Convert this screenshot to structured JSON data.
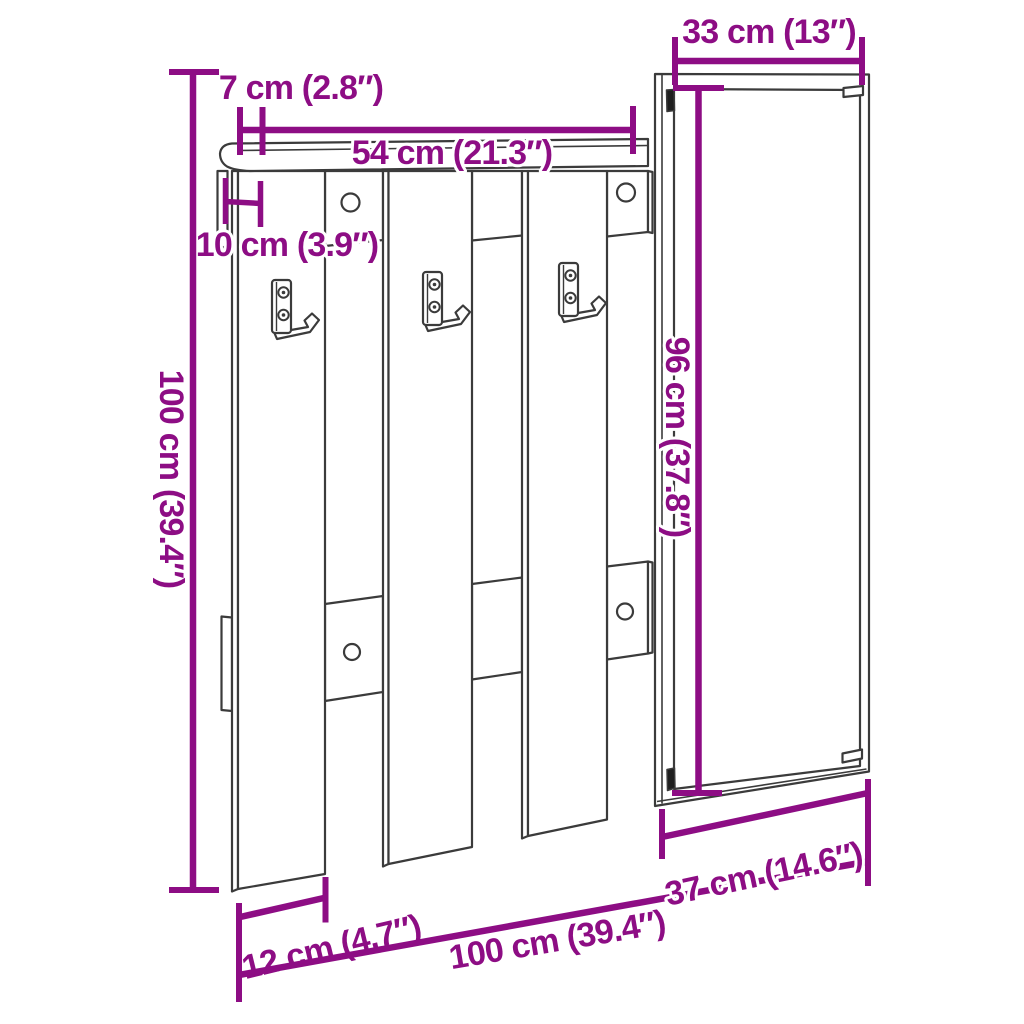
{
  "diagram": {
    "subject": "Wall-mounted hallway coat rack with shelf, three hooks and mirror cabinet — dimension drawing",
    "style": {
      "dimension_color": "#8D0D84",
      "line_color": "#3B3B3B",
      "background": "#FFFFFF"
    },
    "dimensions": {
      "mirror_width": {
        "label": "33 cm (13″)"
      },
      "shelf_depth": {
        "label": "7 cm (2.8″)"
      },
      "rack_width": {
        "label": "54 cm (21.3″)"
      },
      "unit_depth": {
        "label": "10 cm (3.9″)"
      },
      "overall_height": {
        "label": "100 cm (39.4″)"
      },
      "mirror_height": {
        "label": "96 cm (37.8″)"
      },
      "mirror_panel_width": {
        "label": "37 cm (14.6″)"
      },
      "slat_width": {
        "label": "12 cm (4.7″)"
      },
      "overall_width": {
        "label": "100 cm (39.4″)"
      }
    }
  }
}
